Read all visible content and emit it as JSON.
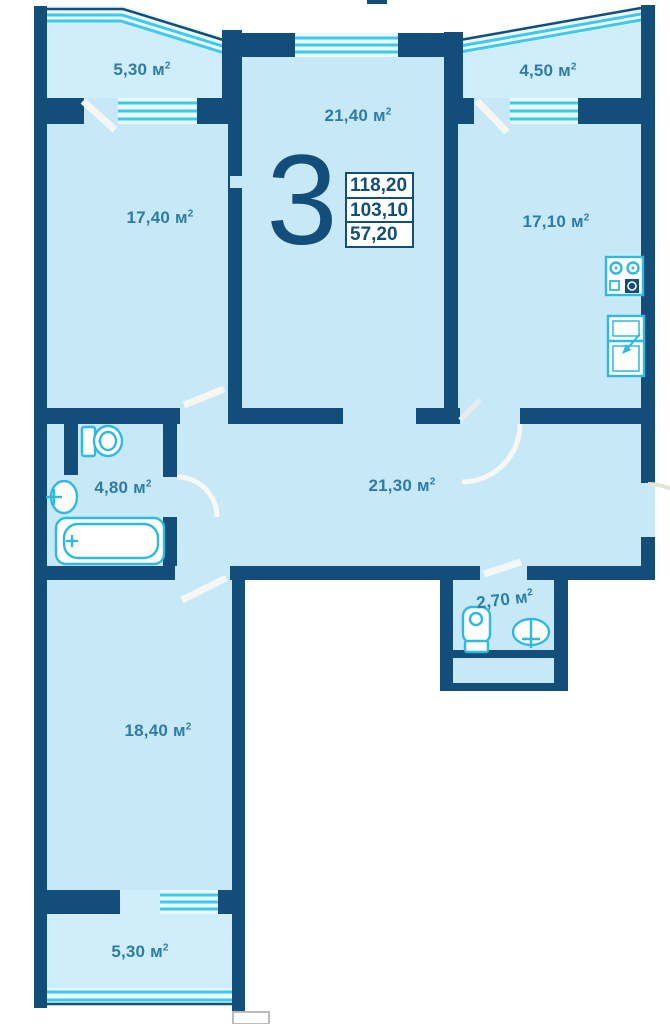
{
  "unit": {
    "number": "3",
    "stats": [
      "118,20",
      "103,10",
      "57,20"
    ]
  },
  "labels": {
    "unit_symbol": "м",
    "sup": "2"
  },
  "rooms": [
    {
      "key": "balcony-top-left",
      "value": "5,30"
    },
    {
      "key": "living-left",
      "value": "17,40"
    },
    {
      "key": "living-middle",
      "value": "21,40"
    },
    {
      "key": "balcony-top-right",
      "value": "4,50"
    },
    {
      "key": "kitchen",
      "value": "17,10"
    },
    {
      "key": "bathroom",
      "value": "4,80"
    },
    {
      "key": "hallway",
      "value": "21,30"
    },
    {
      "key": "wc",
      "value": "2,70"
    },
    {
      "key": "living-bottom",
      "value": "18,40"
    },
    {
      "key": "balcony-bottom",
      "value": "5,30"
    }
  ],
  "colors": {
    "wall": "#134e7a",
    "room": "#c7e8f6",
    "balcony": "#cfedfa",
    "glaze": "#e8f8fd",
    "window": "#3ec8ea",
    "fixture": "#2fb9dd",
    "label": "#2e7ca6",
    "value": "#134e7a",
    "arc": "#f7f8f5",
    "arc_out": "#e4e4df"
  }
}
